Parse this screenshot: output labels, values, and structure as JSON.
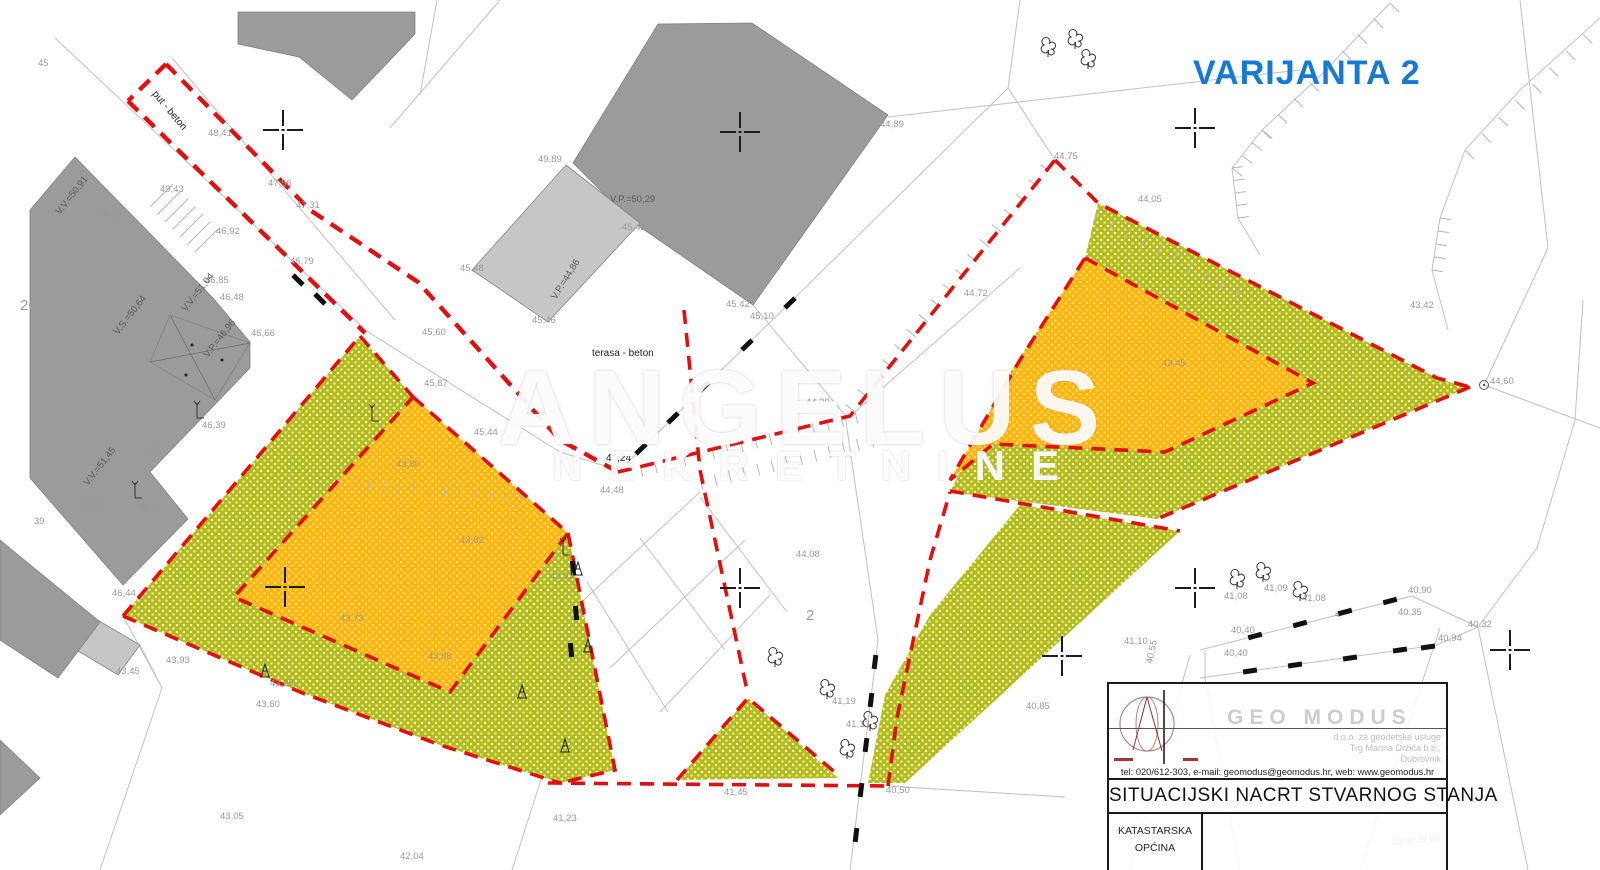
{
  "page": {
    "title_text": "VARIJANTA 2",
    "title_color": "#1679d3"
  },
  "watermark": {
    "line1": "ANGELUS",
    "line2": "NEKRETNINE"
  },
  "title_block": {
    "company": "GEO MODUS",
    "company_sub1": "d.o.o. za geodetske usluge",
    "company_sub2": "Trg Marina Držića b.b.,",
    "company_sub3": "Dubrovnik",
    "contact": "tel: 020/612-303, e-mail: geomodus@geomodus.hr, web: www.geomodus.hr",
    "doc_title": "SITUACIJSKI NACRT STVARNOG STANJA",
    "cell1_line1": "KATASTARSKA",
    "cell1_line2": "OPĆINA"
  },
  "map": {
    "colors": {
      "parcel_green": "#b4bb1c",
      "parcel_orange": "#ffb60a",
      "boundary_red": "#e01010",
      "building_gray": "#9b9b9b",
      "building_light": "#c6c6c6",
      "line_gray": "#c0c0c0"
    },
    "labels": [
      {
        "t": "45",
        "x": 38,
        "y": 66
      },
      {
        "t": "48,25",
        "x": 98,
        "y": 218
      },
      {
        "t": "put - beton",
        "x": 152,
        "y": 94,
        "c": "k",
        "r": 50
      },
      {
        "t": "48,41",
        "x": 208,
        "y": 136
      },
      {
        "t": "49,43",
        "x": 160,
        "y": 192
      },
      {
        "t": "47,56",
        "x": 268,
        "y": 186
      },
      {
        "t": "47,31",
        "x": 296,
        "y": 208
      },
      {
        "t": "46,92",
        "x": 216,
        "y": 234
      },
      {
        "t": "46,79",
        "x": 290,
        "y": 264
      },
      {
        "t": "46,85",
        "x": 205,
        "y": 283
      },
      {
        "t": "46,48",
        "x": 220,
        "y": 300
      },
      {
        "t": "46,66",
        "x": 251,
        "y": 336
      },
      {
        "t": "46,62",
        "x": 196,
        "y": 391
      },
      {
        "t": "46,39",
        "x": 202,
        "y": 428
      },
      {
        "t": "26",
        "x": 20,
        "y": 310,
        "c": "big"
      },
      {
        "t": "39",
        "x": 34,
        "y": 524
      },
      {
        "t": "46,58",
        "x": 80,
        "y": 507
      },
      {
        "t": "46,42",
        "x": 138,
        "y": 509
      },
      {
        "t": "2,04",
        "x": 142,
        "y": 452
      },
      {
        "t": "V.V.=50,91",
        "x": 60,
        "y": 215,
        "c": "d",
        "r": -52
      },
      {
        "t": "V.S.=50,64",
        "x": 118,
        "y": 335,
        "c": "d",
        "r": -52
      },
      {
        "t": "V.V.=51,04",
        "x": 186,
        "y": 312,
        "c": "d",
        "r": -52
      },
      {
        "t": "V.P.=46,96",
        "x": 208,
        "y": 358,
        "c": "d",
        "r": -52
      },
      {
        "t": "V.V.=51,45",
        "x": 88,
        "y": 486,
        "c": "d",
        "r": -52
      },
      {
        "t": "46,44",
        "x": 112,
        "y": 596
      },
      {
        "t": "43,45",
        "x": 116,
        "y": 674
      },
      {
        "t": "43,93",
        "x": 166,
        "y": 663
      },
      {
        "t": "43,20",
        "x": 270,
        "y": 686
      },
      {
        "t": "43,60",
        "x": 256,
        "y": 707
      },
      {
        "t": "43,05",
        "x": 220,
        "y": 819
      },
      {
        "t": "42,04",
        "x": 400,
        "y": 859
      },
      {
        "t": "49,89",
        "x": 538,
        "y": 162
      },
      {
        "t": "V.P.=50,29",
        "x": 610,
        "y": 202,
        "c": "d"
      },
      {
        "t": "45,42",
        "x": 622,
        "y": 230
      },
      {
        "t": "45,48",
        "x": 460,
        "y": 271
      },
      {
        "t": "V.P.=44,86",
        "x": 556,
        "y": 300,
        "c": "d",
        "r": -58
      },
      {
        "t": "45,46",
        "x": 532,
        "y": 323
      },
      {
        "t": "45,42",
        "x": 726,
        "y": 307
      },
      {
        "t": "45,10",
        "x": 750,
        "y": 319
      },
      {
        "t": "44,89",
        "x": 880,
        "y": 127
      },
      {
        "t": "45,60",
        "x": 422,
        "y": 335
      },
      {
        "t": "45,87",
        "x": 424,
        "y": 386
      },
      {
        "t": "45,44",
        "x": 474,
        "y": 435
      },
      {
        "t": "terasa - beton",
        "x": 592,
        "y": 356,
        "c": "k"
      },
      {
        "t": "45,24",
        "x": 606,
        "y": 461,
        "c": "k"
      },
      {
        "t": "44,48",
        "x": 600,
        "y": 493
      },
      {
        "t": "44,29",
        "x": 806,
        "y": 405
      },
      {
        "t": "43,80",
        "x": 396,
        "y": 467
      },
      {
        "t": "43,82",
        "x": 460,
        "y": 543
      },
      {
        "t": "43,73",
        "x": 340,
        "y": 621
      },
      {
        "t": "43,88",
        "x": 428,
        "y": 659
      },
      {
        "t": "43,93",
        "x": 550,
        "y": 579
      },
      {
        "t": "44,08",
        "x": 796,
        "y": 557
      },
      {
        "t": "2",
        "x": 806,
        "y": 620,
        "c": "big"
      },
      {
        "t": "41,45",
        "x": 724,
        "y": 795
      },
      {
        "t": "41,23",
        "x": 553,
        "y": 821
      },
      {
        "t": "40,50",
        "x": 886,
        "y": 793
      },
      {
        "t": "41,13",
        "x": 846,
        "y": 727
      },
      {
        "t": "41,19",
        "x": 832,
        "y": 704
      },
      {
        "t": "44,75",
        "x": 1054,
        "y": 159
      },
      {
        "t": "44,05",
        "x": 1138,
        "y": 202
      },
      {
        "t": "44,72",
        "x": 964,
        "y": 296
      },
      {
        "t": "43,42",
        "x": 1410,
        "y": 308
      },
      {
        "t": "44,60",
        "x": 1490,
        "y": 384
      },
      {
        "t": "43,45",
        "x": 1162,
        "y": 366
      },
      {
        "t": "41,08",
        "x": 1224,
        "y": 599
      },
      {
        "t": "41,09",
        "x": 1264,
        "y": 591
      },
      {
        "t": "41,08",
        "x": 1302,
        "y": 601
      },
      {
        "t": "40,90",
        "x": 1408,
        "y": 593
      },
      {
        "t": "40,35",
        "x": 1398,
        "y": 615
      },
      {
        "t": "40,40",
        "x": 1231,
        "y": 633
      },
      {
        "t": "40,40",
        "x": 1224,
        "y": 656
      },
      {
        "t": "40,32",
        "x": 1468,
        "y": 627
      },
      {
        "t": "40,94",
        "x": 1438,
        "y": 641
      },
      {
        "t": "≈",
        "x": 1335,
        "y": 618,
        "c": "d"
      },
      {
        "t": "41,10",
        "x": 1124,
        "y": 644
      },
      {
        "t": "40,85",
        "x": 1026,
        "y": 709
      },
      {
        "t": "40,55",
        "x": 1152,
        "y": 664,
        "r": -78
      },
      {
        "t": "39,90",
        "x": 1392,
        "y": 844
      },
      {
        "t": "39,80",
        "x": 1416,
        "y": 842
      }
    ],
    "symbols": {
      "crosses": [
        [
          283,
          130
        ],
        [
          740,
          132
        ],
        [
          1195,
          128
        ],
        [
          285,
          587
        ],
        [
          740,
          588
        ],
        [
          1195,
          588
        ],
        [
          1062,
          656
        ],
        [
          1510,
          650
        ]
      ],
      "trees": [
        [
          1237,
          580
        ],
        [
          1263,
          573
        ],
        [
          1300,
          592
        ],
        [
          827,
          690
        ],
        [
          870,
          722
        ],
        [
          847,
          750
        ],
        [
          775,
          658
        ],
        [
          1048,
          48
        ],
        [
          1075,
          40
        ],
        [
          1088,
          60
        ]
      ],
      "poles": [
        [
          265,
          670
        ],
        [
          522,
          691
        ],
        [
          578,
          568
        ],
        [
          588,
          645
        ],
        [
          565,
          745
        ]
      ],
      "flags": [
        [
          197,
          412
        ],
        [
          135,
          492
        ],
        [
          372,
          415
        ],
        [
          563,
          549
        ]
      ],
      "wall_dashes": [
        [
          641,
          449,
          -44
        ],
        [
          673,
          418,
          -44
        ],
        [
          704,
          387,
          -44
        ],
        [
          747,
          345,
          -44
        ],
        [
          790,
          303,
          -44
        ],
        [
          875,
          662,
          97
        ],
        [
          871,
          700,
          97
        ],
        [
          866,
          745,
          97
        ],
        [
          861,
          790,
          97
        ],
        [
          856,
          835,
          97
        ],
        [
          1255,
          636,
          -15
        ],
        [
          1300,
          624,
          -15
        ],
        [
          1345,
          612,
          -15
        ],
        [
          1390,
          601,
          -15
        ],
        [
          1250,
          671,
          -8
        ],
        [
          1295,
          665,
          -8
        ],
        [
          1350,
          658,
          -8
        ],
        [
          1400,
          650,
          -8
        ],
        [
          1428,
          647,
          -8
        ],
        [
          298,
          280,
          45
        ],
        [
          320,
          299,
          45
        ],
        [
          573,
          568,
          85
        ],
        [
          576,
          613,
          85
        ],
        [
          571,
          650,
          85
        ]
      ],
      "junction_circle": [
        1484,
        385
      ]
    }
  }
}
